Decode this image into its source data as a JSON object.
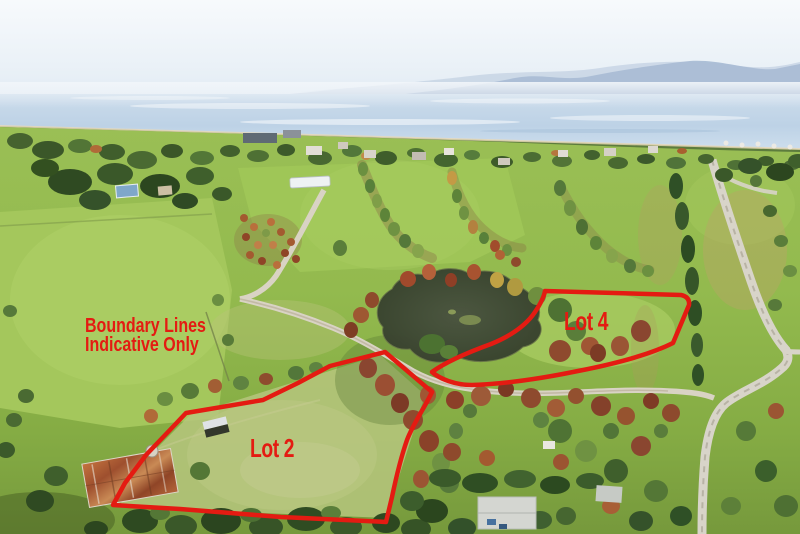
{
  "annotations": {
    "boundary_color": "#e41b12",
    "disclaimer_line1": "Boundary Lines",
    "disclaimer_line2": "Indicative Only",
    "lot2_label": "Lot 2",
    "lot4_label": "Lot 4"
  }
}
